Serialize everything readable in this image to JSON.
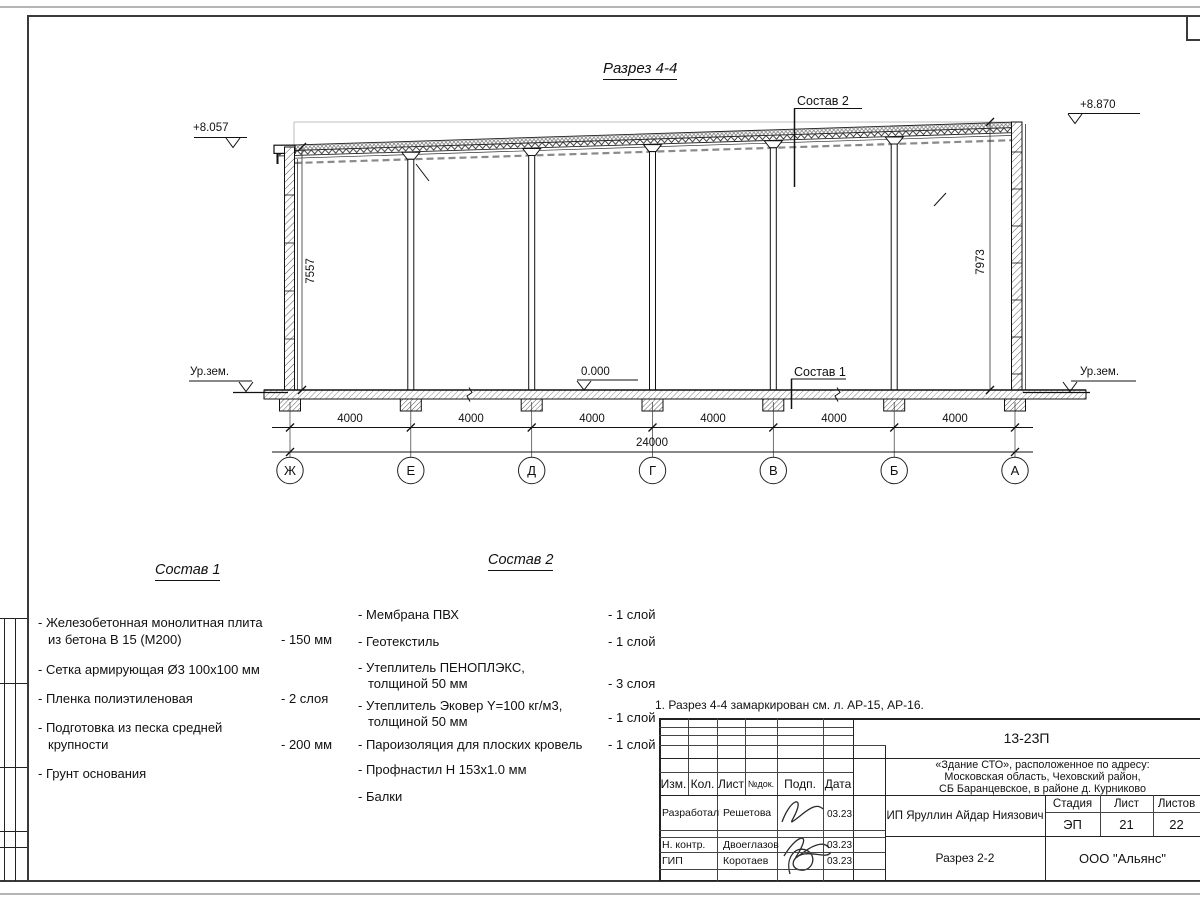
{
  "section": {
    "title": "Разрез 4-4",
    "elevation_left": "+8.057",
    "elevation_right": "+8.870",
    "elevation_zero": "0.000",
    "ground_label": "Ур.зем.",
    "height_left": "7557",
    "height_right": "7973",
    "callout1": "Состав 1",
    "callout2": "Состав 2",
    "axes": [
      "Ж",
      "Е",
      "Д",
      "Г",
      "В",
      "Б",
      "А"
    ],
    "bay_dims": [
      "4000",
      "4000",
      "4000",
      "4000",
      "4000",
      "4000"
    ],
    "total_dim": "24000"
  },
  "comp1": {
    "title": "Состав 1",
    "items": [
      {
        "l1": "- Железобетонная  монолитная плита",
        "l2": "из бетона В 15 (М200)",
        "val": "- 150 мм"
      },
      {
        "l1": "- Сетка армирующая Ø3 100х100 мм"
      },
      {
        "l1": "- Пленка полиэтиленовая",
        "val": "-  2 слоя"
      },
      {
        "l1": "- Подготовка из песка средней",
        "l2": "крупности",
        "val": "- 200 мм"
      },
      {
        "l1": "- Грунт основания"
      }
    ]
  },
  "comp2": {
    "title": "Состав 2",
    "items": [
      {
        "l1": "- Мембрана ПВХ",
        "val": "- 1 слой"
      },
      {
        "l1": "- Геотекстиль",
        "val": "- 1 слой"
      },
      {
        "l1": "- Утеплитель ПЕНОПЛЭКС,",
        "l2": "толщиной 50 мм",
        "val": "- 3 слоя"
      },
      {
        "l1": "- Утеплитель Эковер Y=100 кг/м3,",
        "l2": "толщиной 50 мм",
        "val": "- 1 слой"
      },
      {
        "l1": "- Пароизоляция для плоских кровель",
        "val": "- 1 слой"
      },
      {
        "l1": "- Профнастил Н 153х1.0 мм"
      },
      {
        "l1": "- Балки"
      }
    ]
  },
  "note": "1. Разрез 4-4 замаркирован см. л. АР-15, АР-16.",
  "titleblock": {
    "doc_number": "13-23П",
    "address_line1": "«Здание СТО», расположенное по адресу:",
    "address_line2": "Московская область, Чеховский район,",
    "address_line3": "СБ Баранцевское, в районе д. Курниково",
    "header_cols": [
      "Изм.",
      "Кол.",
      "Лист",
      "№док.",
      "Подп.",
      "Дата"
    ],
    "client": "ИП Яруллин Айдар Ниязович",
    "sheet_title": "Разрез 2-2",
    "company": "ООО \"Альянс\"",
    "stage_label": "Стадия",
    "sheet_label": "Лист",
    "sheets_label": "Листов",
    "stage": "ЭП",
    "sheet": "21",
    "sheets": "22",
    "rows": [
      {
        "role": "Разработал",
        "name": "Решетова",
        "date": "03.23"
      },
      {
        "role": "Н. контр.",
        "name": "Двоеглазов",
        "date": "03.23"
      },
      {
        "role": "ГИП",
        "name": "Коротаев",
        "date": "03.23"
      }
    ]
  }
}
